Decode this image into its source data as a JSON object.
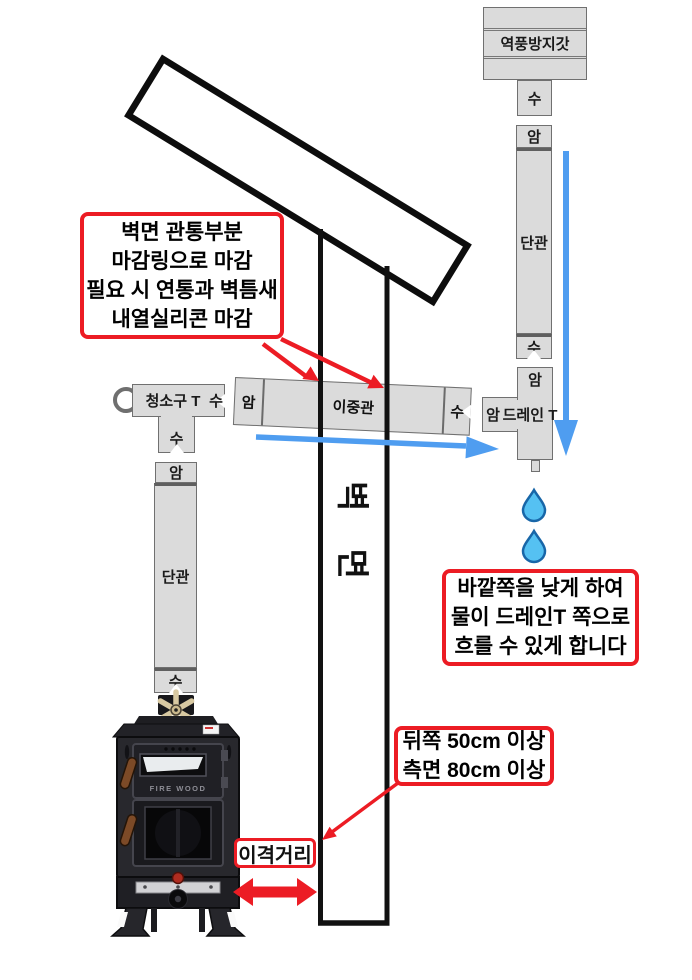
{
  "labels": {
    "cap": "역풍방지갓",
    "male": "수",
    "female": "암",
    "single_pipe": "단관",
    "double_pipe": "이중관",
    "drain_tee": "드레인 T",
    "clean_tee": "청소구 T",
    "wall": "벽 면",
    "clearance": "이격거리",
    "stove_brand": "FIRE WOOD"
  },
  "callouts": {
    "wall_penetration": [
      "벽면 관통부분",
      "마감링으로 마감",
      "필요 시 연통과 벽틈새",
      "내열실리콘 마감"
    ],
    "drain_flow": [
      "바깥쪽을 낮게 하여",
      "물이 드레인T 쪽으로",
      "흐를 수 있게 합니다"
    ],
    "clearance_spec": [
      "뒤쪽 50cm 이상",
      "측면 80cm 이상"
    ]
  },
  "colors": {
    "red": "#EC1C24",
    "blue": "#4F9DF0",
    "pipe_fill": "#DBDBDB",
    "pipe_border": "#707070",
    "drop_fill": "#55C1F2",
    "drop_stroke": "#1866A8"
  }
}
